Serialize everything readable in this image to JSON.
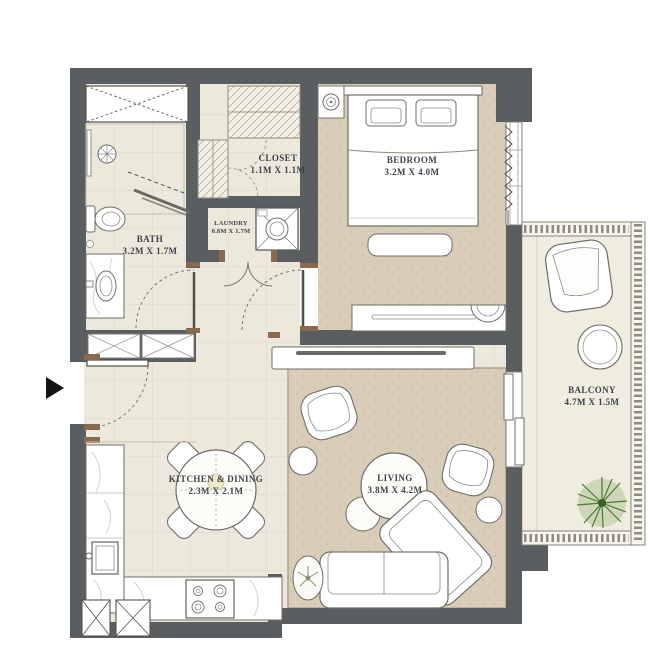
{
  "floorplan": {
    "rooms": [
      {
        "name": "BATH",
        "dims": "3.2M X 1.7M"
      },
      {
        "name": "CLOSET",
        "dims": "1.1M X 1.1M"
      },
      {
        "name": "LAUNDRY",
        "dims": "0.8M X 1.7M"
      },
      {
        "name": "BEDROOM",
        "dims": "3.2M X 4.0M"
      },
      {
        "name": "KITCHEN & DINING",
        "dims": "2.3M X 2.1M"
      },
      {
        "name": "LIVING",
        "dims": "3.8M X 4.2M"
      },
      {
        "name": "BALCONY",
        "dims": "4.7M X 1.5M"
      }
    ],
    "colors": {
      "wall": "#5b5e61",
      "floor": "#ede9dc",
      "carpet": "#d9cdba",
      "balcony_floor": "#efece0",
      "accent_wood": "#8a6a4e",
      "plant_green": "#4e7a33",
      "label_text": "#3e434b"
    }
  }
}
